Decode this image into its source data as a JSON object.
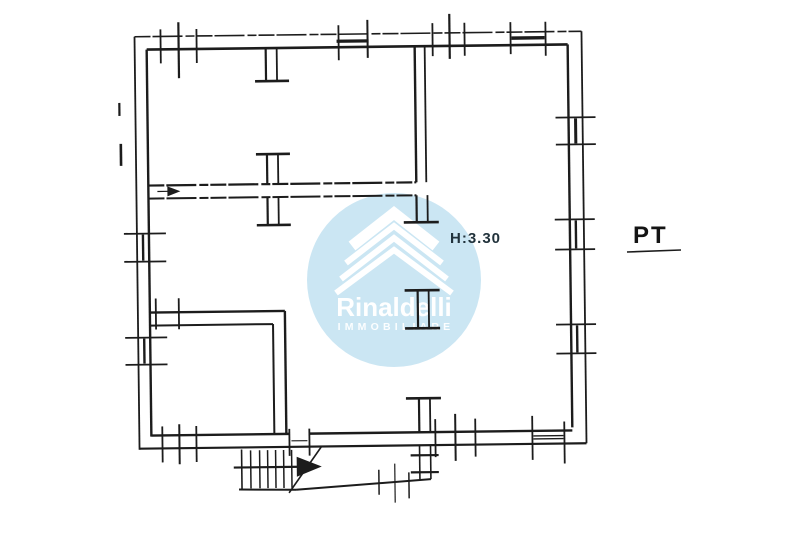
{
  "labels": {
    "height_annotation": "H:3.30",
    "floor_label": "PT"
  },
  "watermark": {
    "brand": "Rinaldelli",
    "tagline": "IMMOBILIARE",
    "circle_color": "#cbe6f3",
    "logo_color": "#ffffff",
    "circle": {
      "cx": 394,
      "cy": 280,
      "r": 87
    },
    "brand_pos": {
      "x": 394,
      "y": 316
    },
    "tagline_pos": {
      "x": 396,
      "y": 330
    },
    "chevrons": [
      {
        "apex_x": 394,
        "apex_y": 213,
        "dx": 42,
        "dy": 33,
        "stroke": 11
      },
      {
        "apex_x": 394,
        "apex_y": 226,
        "dx": 48,
        "dy": 37,
        "stroke": 6
      },
      {
        "apex_x": 394,
        "apex_y": 238,
        "dx": 53,
        "dy": 41,
        "stroke": 6
      },
      {
        "apex_x": 394,
        "apex_y": 250,
        "dx": 58,
        "dy": 43,
        "stroke": 6
      }
    ]
  },
  "colors": {
    "background": "#ffffff",
    "ink": "#1c1c1c"
  },
  "plan": {
    "rotation_deg": -0.7,
    "rotation_center": [
      360,
      240
    ],
    "segments": [
      [
        137,
        34,
        584,
        34,
        1.6,
        1
      ],
      [
        149,
        47,
        570,
        47,
        2.6
      ],
      [
        137,
        34,
        137,
        447,
        1.8
      ],
      [
        149,
        47,
        149,
        434,
        2.4
      ],
      [
        584,
        34,
        584,
        446,
        1.8
      ],
      [
        570,
        47,
        570,
        430,
        2.4
      ],
      [
        137,
        446,
        584,
        446,
        2.2
      ],
      [
        149,
        433,
        287,
        433,
        2.4
      ],
      [
        307,
        433,
        570,
        433,
        2.4
      ],
      [
        417,
        47,
        417,
        183,
        2.4
      ],
      [
        427,
        47,
        427,
        183,
        1.8
      ],
      [
        149,
        183,
        417,
        183,
        2.2,
        1
      ],
      [
        149,
        196,
        417,
        196,
        2.0,
        1
      ],
      [
        417,
        196,
        417,
        222,
        2.2
      ],
      [
        428,
        196,
        428,
        222,
        1.8
      ],
      [
        404,
        223,
        439,
        223,
        2.6
      ],
      [
        404,
        291,
        439,
        291,
        2.6
      ],
      [
        417,
        291,
        417,
        329,
        2.2
      ],
      [
        428,
        291,
        428,
        329,
        1.8
      ],
      [
        404,
        329,
        439,
        329,
        2.6
      ],
      [
        404,
        399,
        439,
        399,
        2.6
      ],
      [
        417,
        399,
        417,
        433,
        2.2
      ],
      [
        428,
        399,
        428,
        433,
        1.8
      ],
      [
        268,
        47,
        268,
        79,
        2.2
      ],
      [
        279,
        47,
        279,
        79,
        1.8
      ],
      [
        257,
        80,
        291,
        80,
        2.6
      ],
      [
        257,
        153,
        291,
        153,
        2.6
      ],
      [
        268,
        153,
        268,
        183,
        2.2
      ],
      [
        279,
        153,
        279,
        183,
        1.8
      ],
      [
        268,
        196,
        268,
        223,
        2.2
      ],
      [
        279,
        196,
        279,
        223,
        1.8
      ],
      [
        257,
        224,
        291,
        224,
        2.6
      ],
      [
        149,
        310,
        284,
        310,
        2.4
      ],
      [
        284,
        310,
        284,
        433,
        2.4
      ],
      [
        149,
        323,
        272,
        323,
        2.0
      ],
      [
        272,
        323,
        272,
        433,
        2.0
      ],
      [
        155,
        296,
        155,
        327,
        1.8
      ],
      [
        178,
        296,
        178,
        327,
        1.8
      ],
      [
        163,
        27,
        163,
        61,
        1.8
      ],
      [
        181,
        20,
        181,
        76,
        2.2
      ],
      [
        199,
        27,
        199,
        61,
        1.8
      ],
      [
        341,
        25,
        341,
        60,
        1.8
      ],
      [
        370,
        20,
        370,
        58,
        2.0
      ],
      [
        339,
        41,
        371,
        41,
        3.2
      ],
      [
        435,
        24,
        435,
        57,
        1.8
      ],
      [
        452,
        15,
        452,
        60,
        2.2
      ],
      [
        467,
        24,
        467,
        57,
        1.8
      ],
      [
        513,
        24,
        513,
        56,
        1.8
      ],
      [
        548,
        24,
        548,
        58,
        1.8
      ],
      [
        514,
        40,
        547,
        40,
        3.4
      ],
      [
        557,
        120,
        597,
        120,
        1.8
      ],
      [
        557,
        147,
        597,
        147,
        1.8
      ],
      [
        577,
        121,
        577,
        146,
        3.0
      ],
      [
        555,
        222,
        595,
        222,
        1.8
      ],
      [
        555,
        252,
        595,
        252,
        1.8
      ],
      [
        576,
        223,
        576,
        251,
        2.4
      ],
      [
        555,
        327,
        595,
        327,
        1.8
      ],
      [
        555,
        356,
        595,
        356,
        1.8
      ],
      [
        576,
        328,
        576,
        355,
        2.4
      ],
      [
        124,
        231,
        166,
        231,
        1.8
      ],
      [
        124,
        259,
        166,
        259,
        1.8
      ],
      [
        143,
        232,
        143,
        258,
        2.4
      ],
      [
        124,
        335,
        166,
        335,
        1.8
      ],
      [
        124,
        362,
        166,
        362,
        1.8
      ],
      [
        143,
        336,
        143,
        361,
        2.4
      ],
      [
        160,
        424,
        160,
        460,
        1.8
      ],
      [
        177,
        422,
        177,
        462,
        2.0
      ],
      [
        194,
        424,
        194,
        460,
        1.8
      ],
      [
        433,
        420,
        433,
        458,
        1.8
      ],
      [
        453,
        415,
        453,
        462,
        2.0
      ],
      [
        473,
        420,
        473,
        458,
        1.8
      ],
      [
        530,
        418,
        530,
        462,
        1.8
      ],
      [
        562,
        424,
        562,
        466,
        1.8
      ],
      [
        531,
        438,
        561,
        438,
        1.4
      ],
      [
        531,
        441,
        561,
        441,
        1.4
      ],
      [
        287,
        428,
        287,
        455,
        1.8
      ],
      [
        307,
        428,
        307,
        455,
        1.8
      ],
      [
        289,
        440,
        305,
        440,
        1.1
      ],
      [
        158,
        189,
        169,
        189,
        1.2
      ],
      [
        239,
        448,
        239,
        489,
        1.6
      ],
      [
        248,
        449,
        248,
        487,
        1.5
      ],
      [
        257,
        449,
        257,
        487,
        1.5
      ],
      [
        265,
        449,
        265,
        487,
        1.5
      ],
      [
        273,
        449,
        273,
        487,
        1.5
      ],
      [
        281,
        449,
        281,
        487,
        1.5
      ],
      [
        289,
        449,
        289,
        487,
        1.5
      ],
      [
        236,
        488,
        293,
        489,
        2.0
      ],
      [
        231,
        466,
        298,
        466,
        2.2
      ],
      [
        286,
        492,
        319,
        446,
        1.6
      ],
      [
        293,
        489,
        428,
        480,
        2.0
      ],
      [
        417,
        446,
        417,
        480,
        1.6
      ],
      [
        428,
        446,
        428,
        480,
        1.6
      ],
      [
        408,
        456,
        436,
        456,
        2.2
      ],
      [
        408,
        473,
        436,
        473,
        2.2
      ],
      [
        376,
        470,
        376,
        495,
        1.5
      ],
      [
        392,
        464,
        392,
        503,
        1.2
      ],
      [
        406,
        473,
        406,
        499,
        1.5
      ],
      [
        121,
        100,
        121,
        113,
        2.2
      ],
      [
        122,
        141,
        122,
        163,
        2.6
      ]
    ],
    "polygons": [
      [
        [
          294,
          456
        ],
        [
          294,
          476
        ],
        [
          319,
          466
        ]
      ],
      [
        [
          168,
          184
        ],
        [
          168,
          194
        ],
        [
          181,
          189
        ]
      ]
    ],
    "annotation_segments": [
      [
        627,
        252,
        681,
        250,
        1.6
      ]
    ]
  }
}
